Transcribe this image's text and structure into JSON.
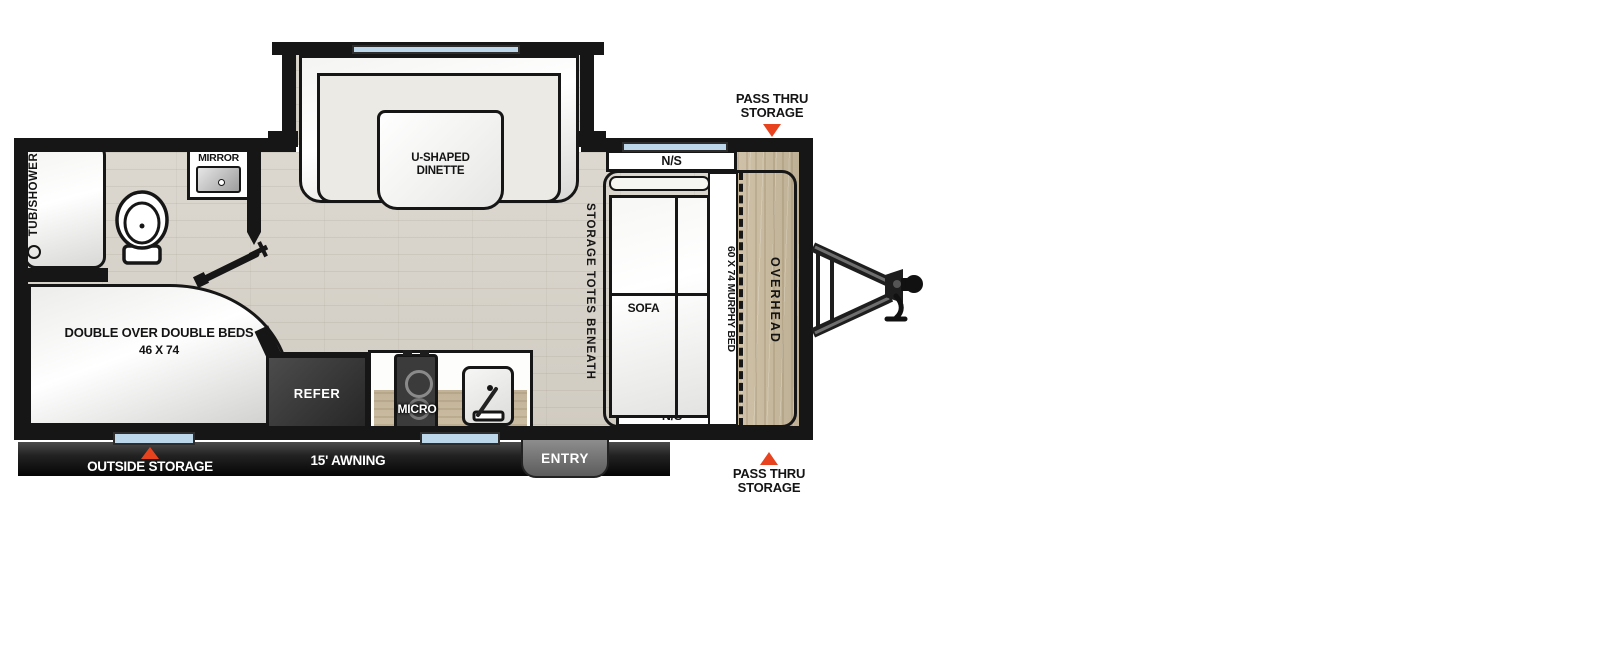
{
  "fp": {
    "dinette": "U-SHAPED DINETTE",
    "tub": "TUB/SHOWER",
    "mirror": "MIRROR",
    "bed_line1": "DOUBLE OVER DOUBLE BEDS",
    "bed_line2": "46 X 74",
    "refer": "REFER",
    "micro": "MICRO",
    "storage_totes": "STORAGE TOTES BENEATH",
    "ns_top": "N/S",
    "ns_bottom": "N/S",
    "sofa": "SOFA",
    "murphy": "60 X 74 MURPHY BED",
    "overhead": "OVERHEAD",
    "pass_thru_top_1": "PASS THRU",
    "pass_thru_top_2": "STORAGE",
    "pass_thru_bottom_1": "PASS THRU",
    "pass_thru_bottom_2": "STORAGE",
    "outside_storage": "OUTSIDE STORAGE",
    "awning": "15' AWNING",
    "entry": "ENTRY"
  },
  "colors": {
    "accent": "#e8431f",
    "wall": "#161616",
    "window": "#bdd7ea",
    "wood": "#c8ba9f",
    "floor": "#d8d3c9"
  }
}
